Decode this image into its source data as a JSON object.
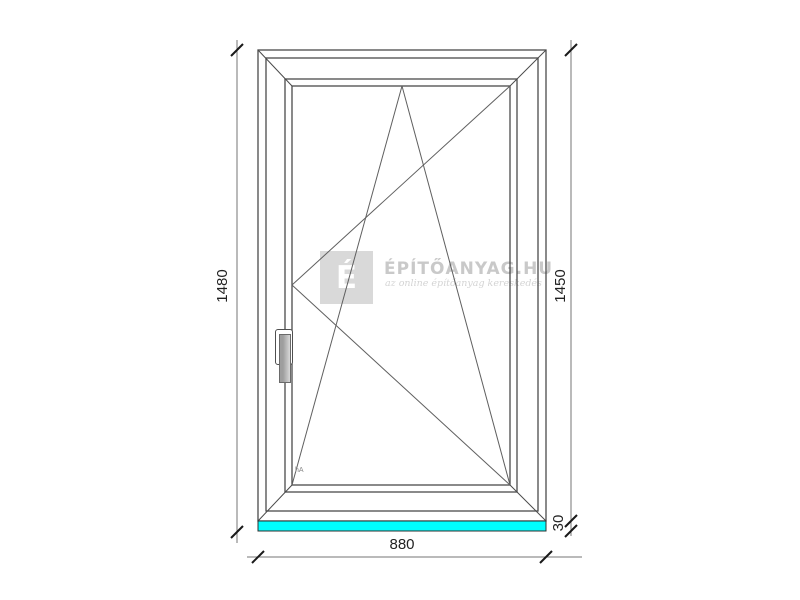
{
  "watermark": {
    "logo_letter": "É",
    "brand": "ÉPÍTŐANYAG.HU",
    "tagline": "az online építőanyag kereskedés",
    "square_color": "#d9d9d9",
    "text_color": "#c9c9c9"
  },
  "dimensions": {
    "height_total": "1480",
    "height_frame": "1450",
    "width": "880",
    "sill_height": "30"
  },
  "drawing": {
    "subject": "tilt-and-turn window elevation",
    "sash_corner_label": "hA",
    "sill_color": "#00ffff",
    "frame_line_color": "#4a4a4a",
    "opening_line_color": "#5f5f5f",
    "dimension_line_color": "#767676",
    "tick_color": "#1a1a1a"
  }
}
